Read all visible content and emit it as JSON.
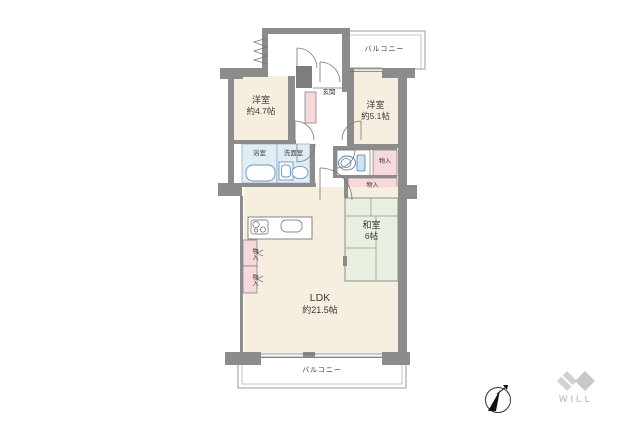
{
  "rooms": {
    "balcony_top": {
      "label": "バルコニー"
    },
    "balcony_bottom": {
      "label": "バルコニー"
    },
    "western1": {
      "label": "洋室",
      "size": "約4.7帖"
    },
    "western2": {
      "label": "洋室",
      "size": "約5.1帖"
    },
    "entrance": {
      "label": "玄関"
    },
    "bath": {
      "label": "浴室"
    },
    "washroom": {
      "label": "洗面室"
    },
    "storage_right": {
      "label": "物入"
    },
    "storage_mid": {
      "label": "物入"
    },
    "storage_kitchen_1": {
      "label": "物入"
    },
    "storage_kitchen_2": {
      "label": "物入"
    },
    "japanese": {
      "label": "和室",
      "size": "6帖"
    },
    "ldk": {
      "label": "LDK",
      "size": "約21.5帖"
    }
  },
  "branding": {
    "logo_text": "WILL"
  },
  "compass": {
    "direction": "north-east"
  },
  "colors": {
    "wall": "#8c8c8c",
    "room_beige": "#f6efe0",
    "storage_pink": "#f8d9db",
    "wet_blue": "#e1edf5",
    "tatami_green": "#e9efe1",
    "line": "#777777",
    "fixture_blue": "#6a94b8",
    "logo_gray": "#cccccc"
  }
}
